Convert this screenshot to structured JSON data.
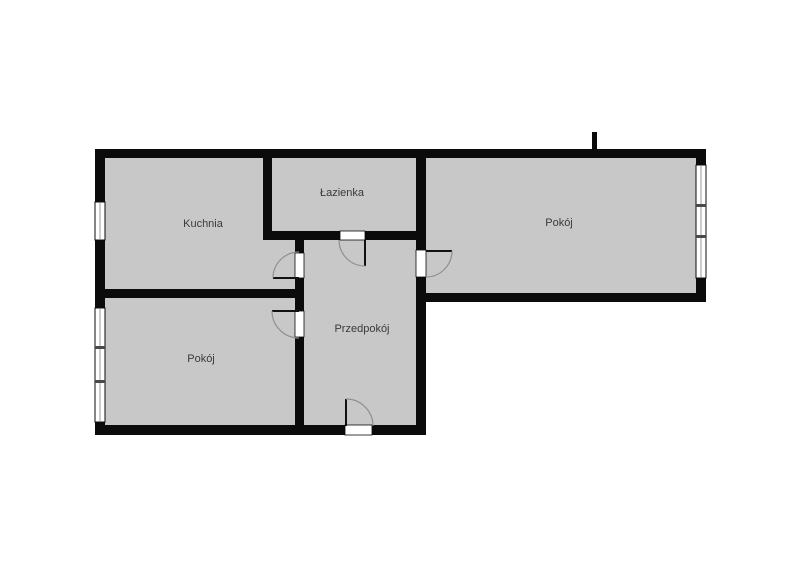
{
  "page": {
    "width": 800,
    "height": 585
  },
  "floorplan": {
    "language": "Polish",
    "rooms": [
      {
        "id": "kuchnia",
        "label": "Kuchnia"
      },
      {
        "id": "lazienka",
        "label": "Łazienka"
      },
      {
        "id": "pokoj-right",
        "label": "Pokój"
      },
      {
        "id": "przedpokoj",
        "label": "Przedpokój"
      },
      {
        "id": "pokoj-left",
        "label": "Pokój"
      }
    ],
    "features": {
      "windows": 3,
      "interior_doors": 4,
      "entrance_doors": 1,
      "chimney_mark": 1
    },
    "colors": {
      "page_background": "#ffffff",
      "floor": "#c8c8c8",
      "wall": "#0b0b0b",
      "opening": "#ffffff",
      "glass_line": "#9a9a9a",
      "mullion": "#4a4a4a",
      "door_leaf": "#111111",
      "door_arc": "#8f8f8f",
      "label": "#3a3a3a"
    }
  }
}
